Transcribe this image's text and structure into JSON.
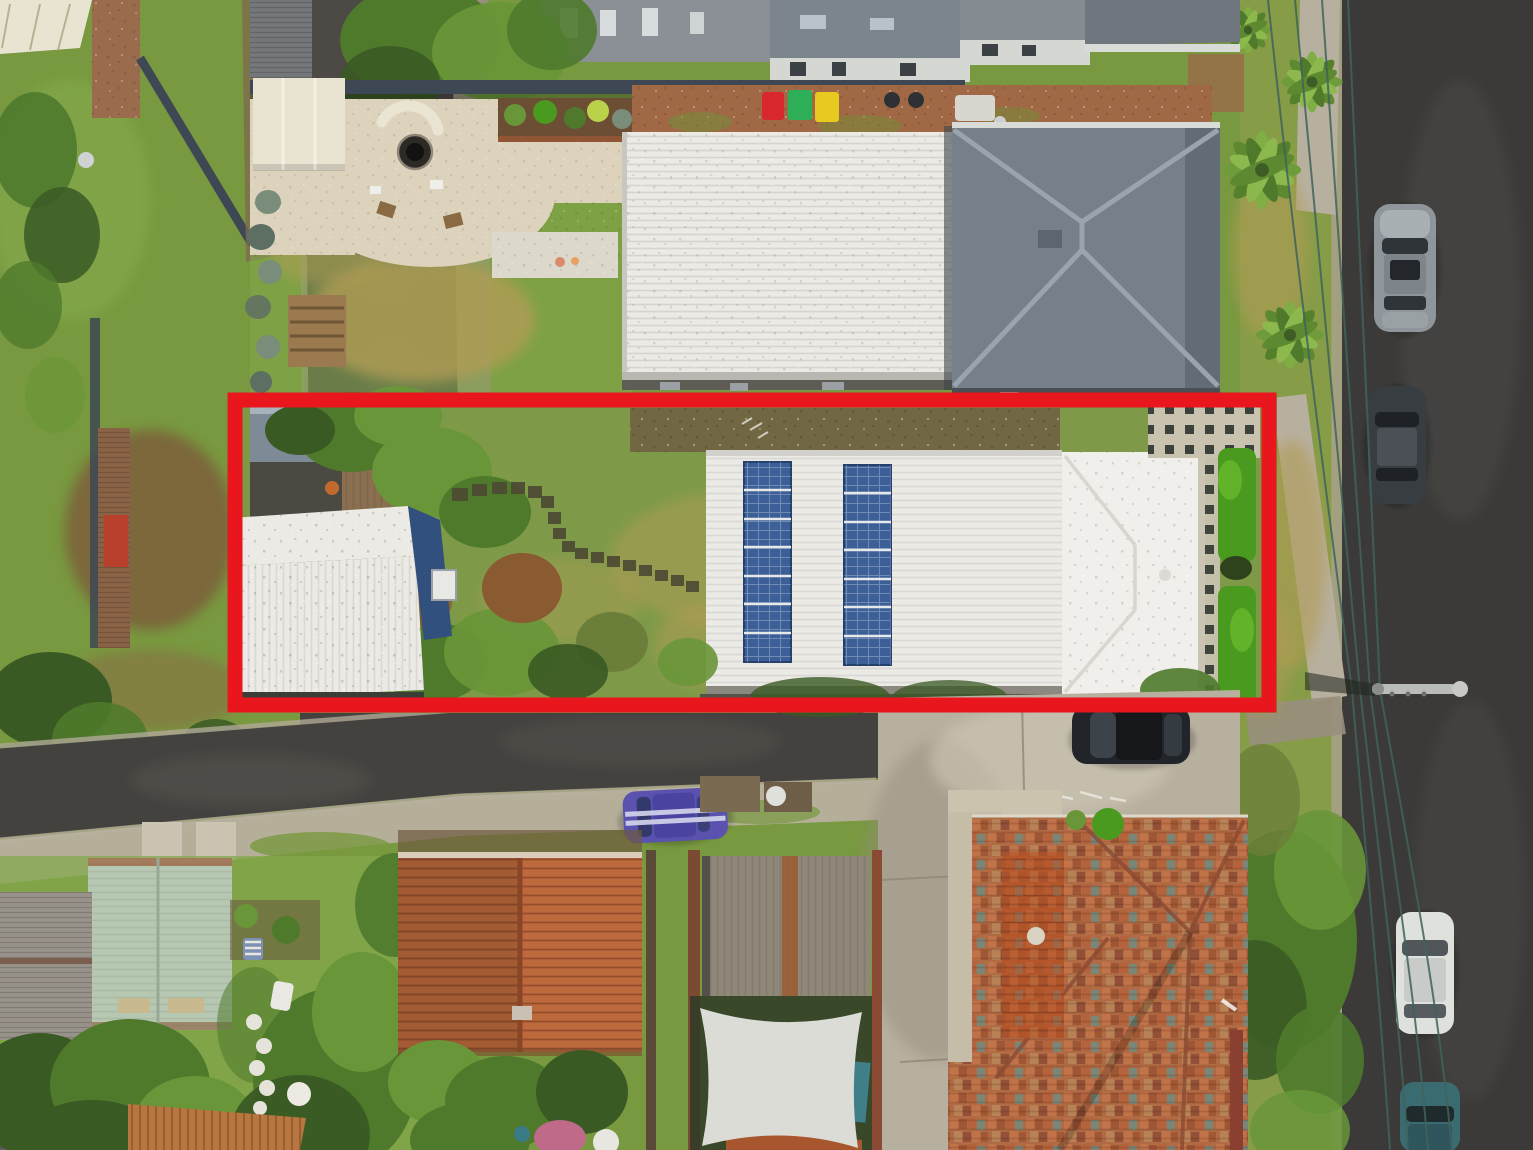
{
  "meta": {
    "image_type": "aerial-drone-photograph",
    "subject": "Top-down real-estate aerial photo of a suburban block; a long narrow property lot is highlighted with a thick red boundary outline."
  },
  "palette": {
    "grass": "#78993f",
    "grassBright": "#84a84d",
    "grassDry": "#b19c55",
    "treeDark": "#3a5a24",
    "treeMid": "#4f7a2c",
    "treeLight": "#699638",
    "hedge": "#4a9a20",
    "shrubRust": "#8a5a30",
    "asphalt": "#44423f",
    "asphaltDark": "#3b3a38",
    "lane": "#4d4944",
    "kerb": "#b0a896",
    "concrete": "#b8b09f",
    "concreteLight": "#ccc4b2",
    "concreteDark": "#988f7d",
    "roofWhite": "#eceae5",
    "roofGrey": "#75808a",
    "roofGreyLight": "#9aa4ac",
    "sage": "#b7c8b2",
    "shingle": "#98938a",
    "oldShed": "#8f8878",
    "terraOrange": "#bc6a3c",
    "tileBase": "#b06a44",
    "tileTeal": "#679089",
    "navy": "#31507d",
    "solar": "#3c5f97",
    "pebble": "#ddd3bd",
    "cream": "#e9e4d2",
    "brick": "#a06844",
    "fence": "#3d4854",
    "fenceBrown": "#7a4a33",
    "sail": "#dcdcd6",
    "wire": "#40635c",
    "redOutline": "#e9161d",
    "binRed": "#d9272e",
    "binGreen": "#2fae58",
    "binYellow": "#e8c91f",
    "carPurple": "#5a52ae",
    "carDark": "#212529",
    "carSilver": "#8e969b",
    "carWhite": "#dfe1dd",
    "carTeal": "#3a6b71"
  },
  "scene": {
    "outline": {
      "x": 235,
      "y": 400,
      "width": 1034,
      "height": 305,
      "stroke_width": 15,
      "color": "#e9161d"
    },
    "highlighted_property": {
      "solar_panel_strips": 2,
      "solar_panels_per_strip": 7,
      "buildings": [
        "large white flat-roof house with rooftop solar panels",
        "white-roof cottage with navy walls",
        "blue-grey garden shed"
      ],
      "features": [
        "lawn with curved stepping-stone path",
        "bright green hedges",
        "checkered paver court",
        "mature trees"
      ]
    },
    "surroundings": {
      "wheelie_bins": [
        "red",
        "green",
        "yellow"
      ],
      "parked_cars": [
        "silver sedan (right street)",
        "dark sedan (right street)",
        "purple car with white stripes (bottom street)",
        "black car (driveway)",
        "white car (right street)",
        "teal car (right street)"
      ],
      "roads": [
        "laneway on left",
        "street across bottom",
        "street on right"
      ],
      "power_pole_with_streetlight": true,
      "overhead_power_lines": 4
    }
  }
}
